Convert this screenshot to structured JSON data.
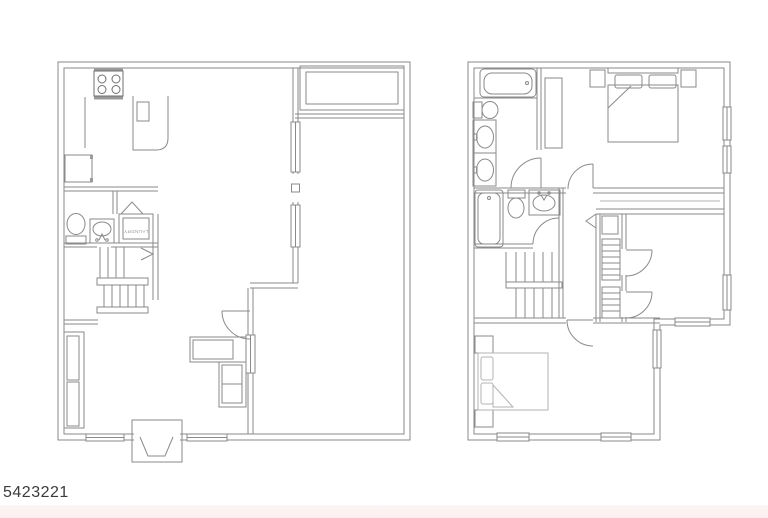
{
  "canvas": {
    "width": 768,
    "height": 518,
    "background_color": "#ffffff",
    "footer_band_color": "#fbeeee",
    "line_color": "#8a8a8a",
    "text_color": "#3b3b3b"
  },
  "listing": {
    "id": "5423221"
  },
  "floor_plans": {
    "first_floor": {
      "name": "first-floor-plan",
      "labels": {
        "laundry": "LAUNDRY"
      },
      "rooms": [
        "kitchen",
        "dining-area",
        "powder-room",
        "laundry-closet",
        "stair-hall",
        "living-room",
        "family-room",
        "entry-stoop",
        "rear-deck"
      ],
      "fixtures": [
        "stove-icon",
        "refrigerator-icon",
        "kitchen-counter",
        "kitchen-sink-icon",
        "toilet-icon",
        "vanity-sink-icon",
        "staircase-icon",
        "stair-direction-arrow",
        "sofa-icon",
        "sectional-sofa-icon",
        "window-icon",
        "door-swing-icon",
        "bifold-door-icon",
        "entry-steps-icon"
      ]
    },
    "second_floor": {
      "name": "second-floor-plan",
      "rooms": [
        "master-bathroom",
        "master-bedroom",
        "hall-bathroom",
        "hallway",
        "closet-strip",
        "bedroom-2",
        "bedroom-3"
      ],
      "fixtures": [
        "bathtub-icon",
        "toilet-icon",
        "double-vanity-sink-icon",
        "vanity-sink-icon",
        "bed-icon",
        "nightstand-icon",
        "wardrobe-icon",
        "staircase-icon",
        "stair-direction-arrow",
        "closet-shelving-icon",
        "window-icon",
        "door-swing-icon"
      ]
    }
  }
}
